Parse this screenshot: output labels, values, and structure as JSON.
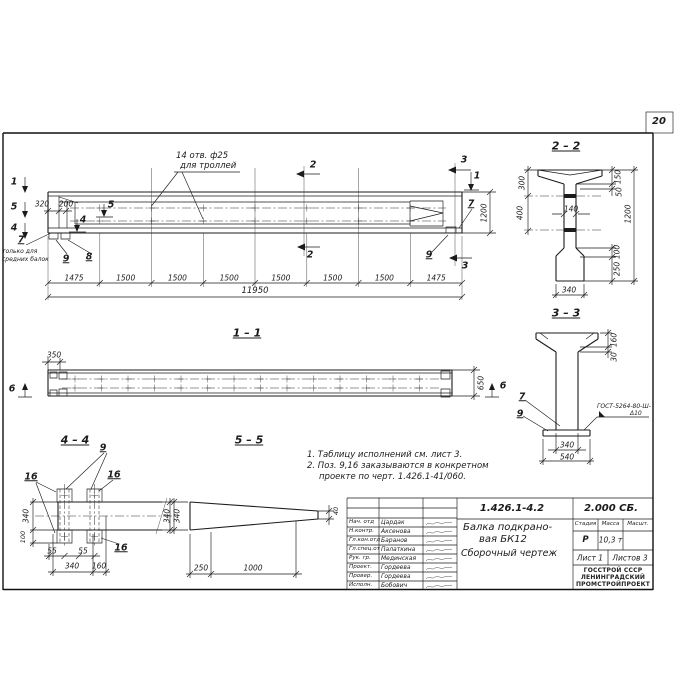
{
  "page": {
    "number": "20"
  },
  "main_view": {
    "hole_note_1": "14 отв. ф25",
    "hole_note_2": "для троллей",
    "dim_320": "320",
    "dim_200": "200",
    "dim_1200": "1200",
    "dim_total": "11950",
    "segments": [
      "1475",
      "1500",
      "1500",
      "1500",
      "1500",
      "1500",
      "1500",
      "1475"
    ],
    "mark_1": "1",
    "mark_5": "5",
    "mark_4": "4",
    "mark_2": "2",
    "mark_3": "3",
    "pos_7": "7",
    "pos_8": "8",
    "pos_9": "9",
    "pos7_note_1": "только для",
    "pos7_note_2": "средних балок"
  },
  "view_1_1": {
    "title": "1 – 1",
    "dim_350": "350",
    "dim_650": "650",
    "mark_6": "6"
  },
  "section_2_2": {
    "title": "2 – 2",
    "dim_300": "300",
    "dim_400": "400",
    "dim_150": "150",
    "dim_50": "50",
    "dim_1200": "1200",
    "dim_140": "140",
    "dim_100": "100",
    "dim_250": "250",
    "dim_340": "340"
  },
  "section_3_3": {
    "title": "3 – 3",
    "dim_160": "160",
    "dim_30": "30",
    "pos_7": "7",
    "pos_9": "9",
    "weld_note_1": "ГОСТ-5264-80-Ш-",
    "weld_note_2": "Δ10",
    "dim_340": "340",
    "dim_540": "540"
  },
  "section_4_4": {
    "title": "4 – 4",
    "pos_9": "9",
    "pos_16": "16",
    "dim_340_left": "340",
    "dim_100": "100",
    "dim_55": "55",
    "dim_340_bottom": "340",
    "dim_160": "160",
    "dim_340_right": "340"
  },
  "section_5_5": {
    "title": "5 – 5",
    "dim_340": "340",
    "dim_250": "250",
    "dim_1000": "1000",
    "dim_40": "40"
  },
  "notes": {
    "line_1": "1. Таблицу исполнений  см. лист 3.",
    "line_2": "2. Поз. 9,16 заказываются в конкретном",
    "line_3": "проекте по черт. 1.426.1-41/060."
  },
  "title_block": {
    "doc_number": "1.426.1-4.2",
    "doc_code": "2.000 СБ.",
    "title_1": "Балка подкрано-",
    "title_2": "вая БК12",
    "title_3": "Сборочный чертеж",
    "col_stage": "Стадия",
    "col_mass": "Масса",
    "col_scale": "Масшт.",
    "stage": "Р",
    "mass": "10,3 т",
    "sheet": "Лист 1",
    "sheets": "Листов 3",
    "org_1": "ГОССТРОЙ СССР",
    "org_2": "ЛЕНИНГРАДСКИЙ",
    "org_3": "ПРОМСТРОЙПРОЕКТ",
    "rows": [
      {
        "role": "Нач. отд",
        "name": "Цардак"
      },
      {
        "role": "Н.контр.",
        "name": "Аксенова"
      },
      {
        "role": "Гл.кон.отд",
        "name": "Баранов"
      },
      {
        "role": "Гл.спец.от",
        "name": "Палаткина"
      },
      {
        "role": "Рук. гр.",
        "name": "Мединская"
      },
      {
        "role": "Проект.",
        "name": "Гордеева"
      },
      {
        "role": "Провер.",
        "name": "Гордеева"
      },
      {
        "role": "Исполн.",
        "name": "Бобович"
      }
    ]
  }
}
